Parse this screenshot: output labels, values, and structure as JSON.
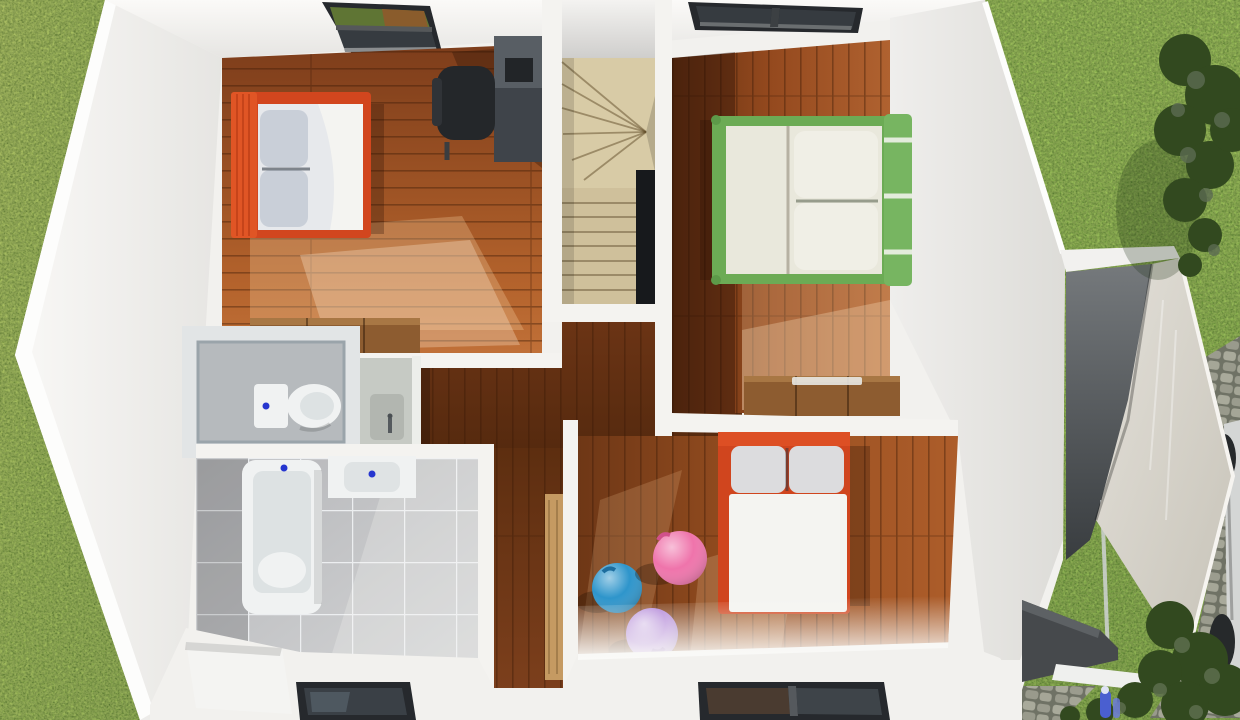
{
  "scene": {
    "kind": "3d-floor-plan-render",
    "view": "top-down-dollhouse",
    "level": "upper-floor",
    "rooms": [
      {
        "id": "bedroom-1",
        "position": "top-left",
        "floor": "wood-planks-horizontal",
        "furniture": [
          "double-bed-red",
          "desk",
          "office-chair",
          "dresser",
          "skylight"
        ]
      },
      {
        "id": "bedroom-2",
        "position": "top-right",
        "floor": "wood-planks-vertical",
        "furniture": [
          "double-bed-green",
          "dresser",
          "skylight"
        ]
      },
      {
        "id": "bedroom-3",
        "position": "bottom-right",
        "floor": "wood-planks-vertical",
        "furniture": [
          "double-bed-red",
          "gym-ball-blue",
          "gym-ball-pink",
          "gym-ball-purple",
          "window"
        ]
      },
      {
        "id": "bathroom",
        "position": "bottom-left",
        "floor": "grey-tiles",
        "furniture": [
          "bathtub",
          "sink",
          "floor-window"
        ]
      },
      {
        "id": "wc",
        "position": "middle-left",
        "floor": "concrete",
        "furniture": [
          "toilet",
          "vanity-basin"
        ]
      },
      {
        "id": "staircase",
        "position": "center",
        "furniture": [
          "winder-steps",
          "straight-steps",
          "stairwell-void"
        ]
      },
      {
        "id": "hallway",
        "position": "center",
        "floor": "dark-wood",
        "furniture": [
          "door-panel"
        ]
      },
      {
        "id": "garage",
        "position": "right",
        "furniture": [
          "slanted-roof",
          "glass-railing"
        ]
      }
    ],
    "exterior": [
      "lawn-left",
      "lawn-right",
      "bush-top-right",
      "bush-bottom-right",
      "cobblestone-path",
      "parked-car",
      "garden-figure"
    ]
  },
  "palette": {
    "grass": "#8ab14b",
    "grass_right": "#82ae45",
    "wall": "#f2f1ee",
    "wall_bright": "#fdfdfc",
    "wall_band": "#f4f3f0",
    "bed1_frame": "#d2461e",
    "bed1_headboard": "#e05525",
    "bed2_frame": "#6cab55",
    "bed2_headboard": "#77b561",
    "bed3_frame": "#d0451e",
    "mattress": "#f4f4f1",
    "bedding_cream": "#e9e8dc",
    "pillow_grey": "#c9cfd8",
    "pillow_light": "#dcdcde",
    "desk": "#3f444a",
    "chair": "#24272a",
    "dresser": "#8d5c30",
    "door_panel": "#c59a62",
    "stair_winder": "#d8cba6",
    "stair_tread": "#cfc09b",
    "stair_void": "#17191c",
    "wc_floor": "#b6babd",
    "fixture_white": "#f0f2f2",
    "drain_dot": "#2636cf",
    "window_frame": "#26292d",
    "glass": "#363b40",
    "garage_dark_floor": "#46494c",
    "car_body": "#d4d6d5",
    "wheel": "#26292b",
    "bush": "#32491f",
    "figure_blue": "#4a5fd0",
    "ball_blue": "#2e95cb",
    "ball_pink": "#ef74ab",
    "ball_purple": "#b286d9"
  }
}
